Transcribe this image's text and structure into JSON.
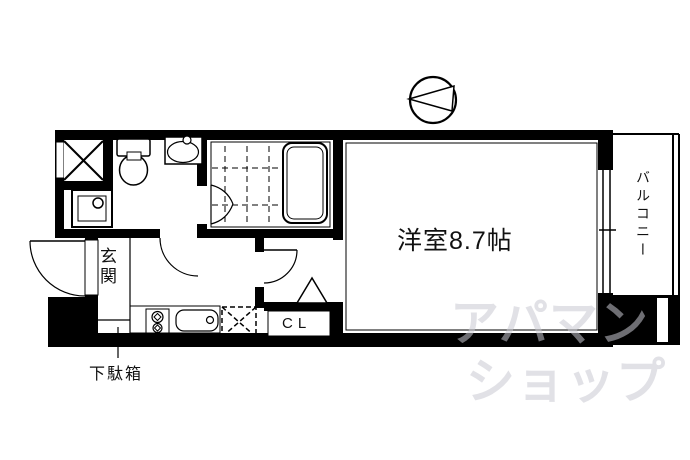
{
  "floorplan": {
    "labels": {
      "room": "洋室8.7帖",
      "balcony": "バルコニー",
      "entrance": "玄関",
      "closet": "CL",
      "shoe_box": "下駄箱"
    },
    "watermark": {
      "line1": "アパマン",
      "line2": "ショップ"
    },
    "colors": {
      "wall": "#000000",
      "background": "#ffffff",
      "watermark": "#c8c8d2"
    },
    "fixtures": {
      "compass": "circle-with-left-pointing-arrow",
      "pipe_space": "x-box",
      "toilet": "tank-and-bowl",
      "wash_basin": "oval-in-square-with-faucet",
      "washing_machine_pan": "double-square-with-drain-circle",
      "bathtub": "double-rounded-rectangle",
      "shower_floor": "dashed-grid",
      "stove": "two-burner",
      "kitchen_sink": "rounded-basin-with-faucet",
      "refrigerator_space": "dashed-x-box",
      "closet_door": "triangle",
      "balcony_window": "double-line-sliding-door"
    }
  }
}
